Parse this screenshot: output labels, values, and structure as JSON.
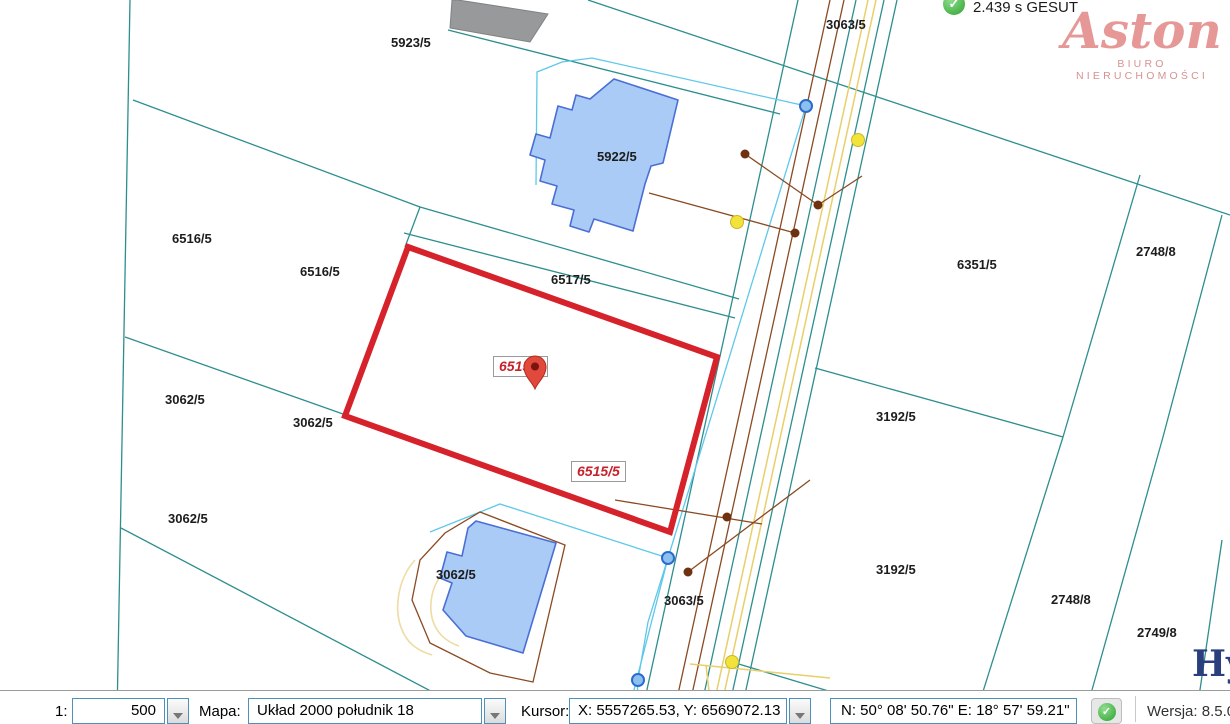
{
  "colors": {
    "teal": "#2d8e8e",
    "cyan": "#5ec8ea",
    "brown": "#8a4a22",
    "brown_dot": "#6e3210",
    "yellow": "#e9cf6a",
    "yellow_light": "#eedca4",
    "yellow_dot": "#f2e33a",
    "red": "#d6222b",
    "red_label": "#c5222c",
    "building_fill": "#a9cbf5",
    "building_stroke": "#4a6fd4",
    "gray_building": "#97999b",
    "blue_node_fill": "#8ec0ee",
    "blue_node_stroke": "#2a6bd0",
    "pin": "#e2493d",
    "logo_pink": "#e59896",
    "watermark_blue": "#2a3f7e",
    "combo_border": "#4d90b8"
  },
  "header": {
    "gesut_status": "2.439 s GESUT",
    "logo_title": "Aston",
    "logo_subtitle": "BIURO NIERUCHOMOŚCI"
  },
  "watermark": "Hyp",
  "map": {
    "parcel_labels": [
      {
        "text": "5923/5",
        "x": 391,
        "y": 35
      },
      {
        "text": "3063/5",
        "x": 826,
        "y": 17
      },
      {
        "text": "5922/5",
        "x": 597,
        "y": 149
      },
      {
        "text": "6516/5",
        "x": 172,
        "y": 231
      },
      {
        "text": "6516/5",
        "x": 300,
        "y": 264
      },
      {
        "text": "6517/5",
        "x": 551,
        "y": 272
      },
      {
        "text": "6351/5",
        "x": 957,
        "y": 257
      },
      {
        "text": "2748/8",
        "x": 1136,
        "y": 244
      },
      {
        "text": "3062/5",
        "x": 165,
        "y": 392
      },
      {
        "text": "3062/5",
        "x": 293,
        "y": 415
      },
      {
        "text": "3192/5",
        "x": 876,
        "y": 409
      },
      {
        "text": "3062/5",
        "x": 168,
        "y": 511
      },
      {
        "text": "3062/5",
        "x": 436,
        "y": 567
      },
      {
        "text": "3063/5",
        "x": 664,
        "y": 593
      },
      {
        "text": "3192/5",
        "x": 876,
        "y": 562
      },
      {
        "text": "2748/8",
        "x": 1051,
        "y": 592
      },
      {
        "text": "2749/8",
        "x": 1137,
        "y": 625
      }
    ],
    "selected_parcel_labels": [
      {
        "text": "6515/5",
        "x": 493,
        "y": 356
      },
      {
        "text": "6515/5",
        "x": 571,
        "y": 461
      }
    ]
  },
  "toolbar": {
    "scale_label": "1:",
    "scale_value": "500",
    "map_label": "Mapa:",
    "map_value": "Układ 2000 południk 18",
    "cursor_label": "Kursor:",
    "cursor_value": "X: 5557265.53, Y: 6569072.13",
    "coords_value": "N: 50° 08' 50.76\" E: 18° 57' 59.21\"",
    "version_label": "Wersja: 8.5.0"
  }
}
